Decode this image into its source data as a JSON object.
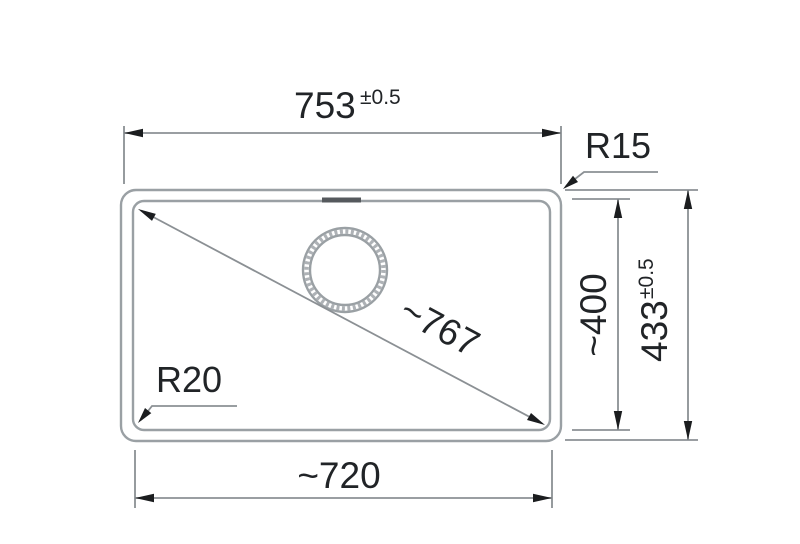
{
  "drawing": {
    "kind": "sink-installation-dimension-drawing",
    "dimensions": {
      "top_width": {
        "value": "753",
        "tolerance": "±0.5"
      },
      "outer_height": {
        "value": "433",
        "tolerance": "±0.5"
      },
      "inner_height": {
        "value": "~400"
      },
      "bottom_width": {
        "value": "~720"
      },
      "diagonal": {
        "value": "~767"
      },
      "top_corner_radius": {
        "label": "R15"
      },
      "bottom_corner_radius": {
        "label": "R20"
      }
    },
    "colors": {
      "background": "#ffffff",
      "sink_outline": "#9aa0a4",
      "dimension_lines": "#8b9094",
      "arrows": "#1b1d1f",
      "text": "#212427"
    }
  }
}
